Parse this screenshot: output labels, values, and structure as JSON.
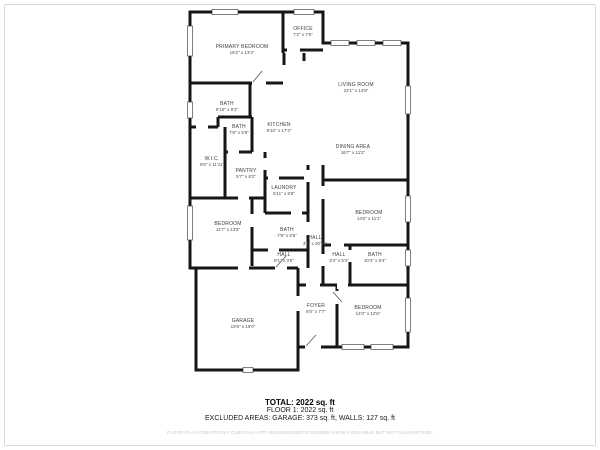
{
  "plan": {
    "rooms": [
      {
        "id": "primary-bedroom",
        "name": "PRIMARY BEDROOM",
        "dims": "16'2\" x 13'3\""
      },
      {
        "id": "office",
        "name": "OFFICE",
        "dims": "7'2\" x 7'5\""
      },
      {
        "id": "living-room",
        "name": "LIVING ROOM",
        "dims": "22'1\" x 14'8\""
      },
      {
        "id": "dining-area",
        "name": "DINING AREA",
        "dims": "16'7\" x 11'2\""
      },
      {
        "id": "bath-primary",
        "name": "BATH",
        "dims": "9'10\" x 9'2\""
      },
      {
        "id": "bath-2",
        "name": "BATH",
        "dims": "7'6\" x 5'9\""
      },
      {
        "id": "kitchen",
        "name": "KITCHEN",
        "dims": "9'10\" x 17'3\""
      },
      {
        "id": "walk-in-closet",
        "name": "W.I.C.",
        "dims": "8'6\" x 11'11\""
      },
      {
        "id": "pantry",
        "name": "PANTRY",
        "dims": "5'7\" x 8'2\""
      },
      {
        "id": "laundry",
        "name": "LAUNDRY",
        "dims": "5'11\" x 6'8\""
      },
      {
        "id": "bedroom-left",
        "name": "BEDROOM",
        "dims": "11'7\" x 13'5\""
      },
      {
        "id": "bath-middle",
        "name": "BATH",
        "dims": "7'9\" x 5'5\""
      },
      {
        "id": "hall-long",
        "name": "HALL",
        "dims": "3'2\" x 20'11\""
      },
      {
        "id": "hall-lower",
        "name": "HALL",
        "dims": "8'1\" x 3'6\""
      },
      {
        "id": "hall-small",
        "name": "HALL",
        "dims": "3'4\" x 5'4\""
      },
      {
        "id": "bath-right",
        "name": "BATH",
        "dims": "10'4\" x 5'4\""
      },
      {
        "id": "bedroom-right",
        "name": "BEDROOM",
        "dims": "14'0\" x 11'1\""
      },
      {
        "id": "bedroom-bottom",
        "name": "BEDROOM",
        "dims": "14'0\" x 12'6\""
      },
      {
        "id": "foyer",
        "name": "FOYER",
        "dims": "6'0\" x 7'7\""
      },
      {
        "id": "garage",
        "name": "GARAGE",
        "dims": "19'6\" x 19'0\""
      }
    ]
  },
  "summary": {
    "total": "TOTAL: 2022 sq. ft",
    "floor": "FLOOR 1: 2022 sq. ft",
    "excluded": "EXCLUDED AREAS: GARAGE: 373 sq. ft, WALLS: 127 sq. ft",
    "disclaimer": "FLOOR PLAN CREATED BY CUBICASA APP. MEASUREMENTS DEEMED HIGHLY RELIABLE BUT NOT GUARANTEED."
  },
  "colors": {
    "wall": "#161616",
    "label": "#3c3c3c",
    "disclaimer": "#c6c6c6",
    "frame": "#d9d9d9"
  }
}
